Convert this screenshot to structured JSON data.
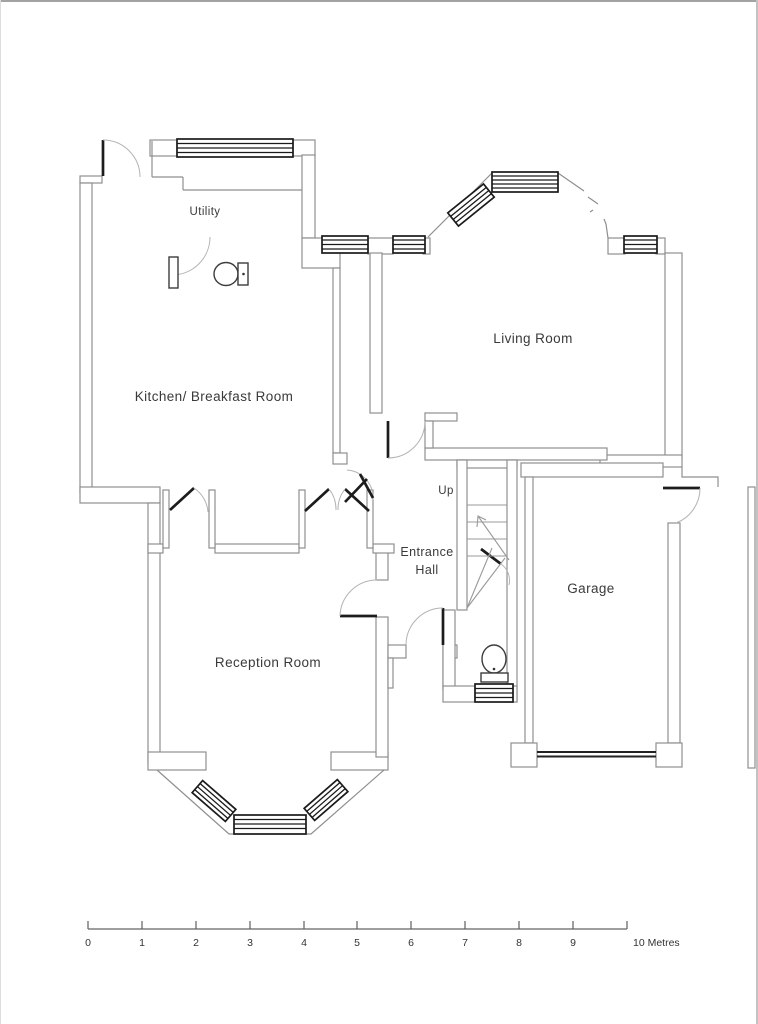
{
  "rooms": {
    "utility": {
      "label": "Utility"
    },
    "kitchen": {
      "label": "Kitchen/ Breakfast Room"
    },
    "living_room": {
      "label": "Living Room"
    },
    "entrance_hall": {
      "line1": "Entrance",
      "line2": "Hall"
    },
    "reception": {
      "label": "Reception Room"
    },
    "garage": {
      "label": "Garage"
    }
  },
  "stairs": {
    "label": "Up"
  },
  "scale_bar": {
    "ticks": [
      "0",
      "1",
      "2",
      "3",
      "4",
      "5",
      "6",
      "7",
      "8",
      "9"
    ],
    "end_label": "10 Metres",
    "max_metres": 10
  },
  "colors": {
    "wall": "#8f8f8f",
    "window": "#1a1a1a",
    "door_leaf": "#1c1c1c",
    "door_arc": "#b3b3b3",
    "text": "#3a3a3a"
  }
}
